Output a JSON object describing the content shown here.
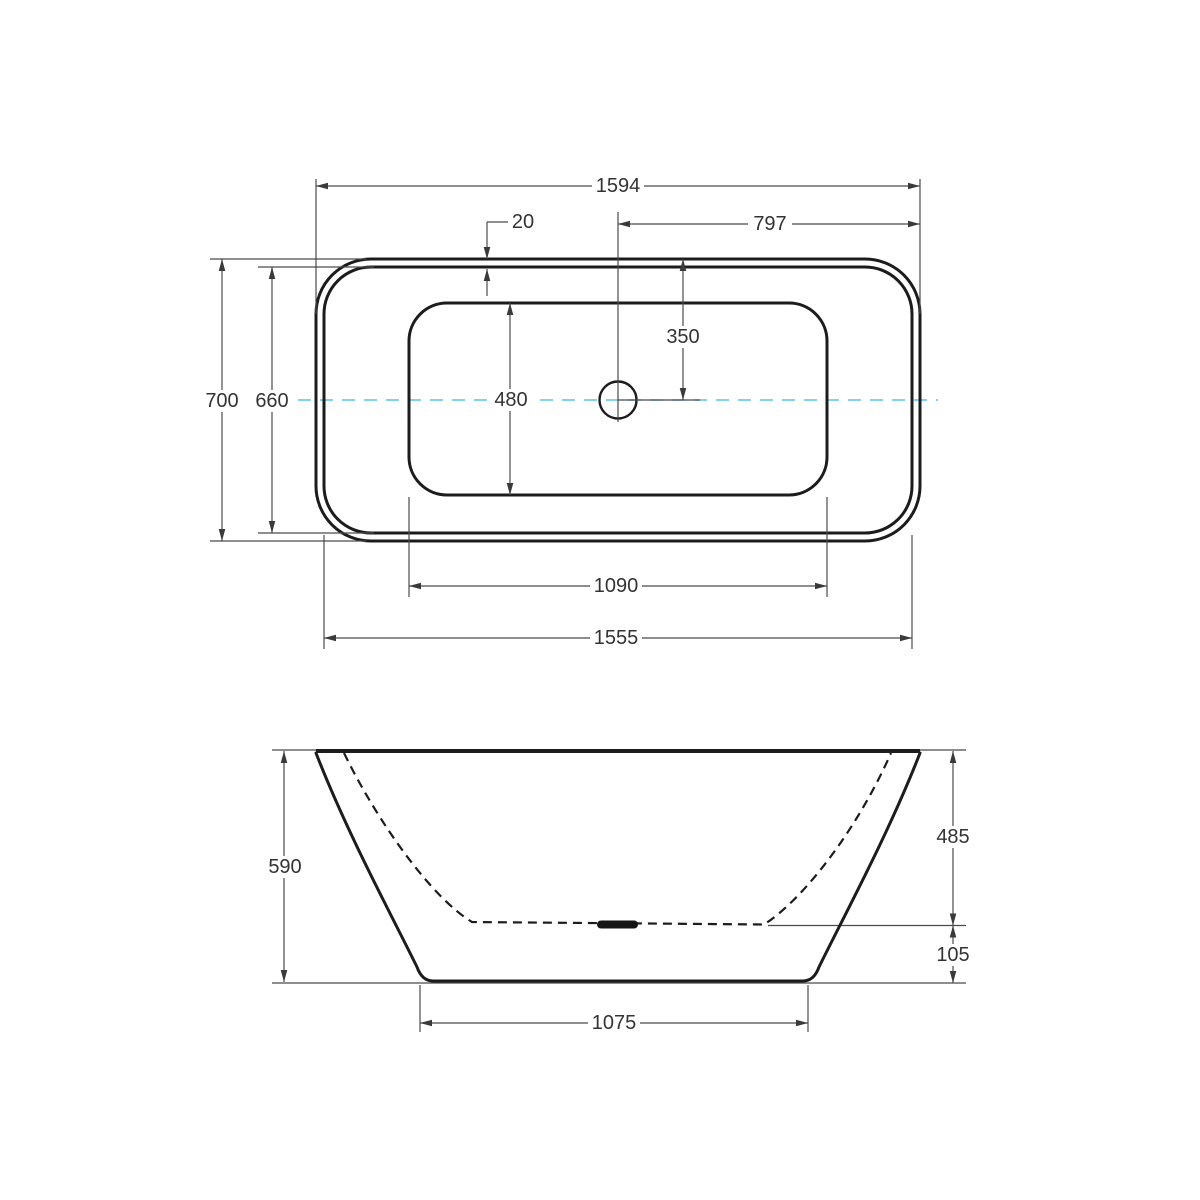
{
  "drawing": {
    "top_view": {
      "dims": {
        "overall_length": "1594",
        "half_length": "797",
        "rim_offset": "20",
        "center_to_edge": "350",
        "overall_width": "700",
        "rim_width": "660",
        "basin_width": "480",
        "basin_length": "1090",
        "rim_length": "1555"
      }
    },
    "side_view": {
      "dims": {
        "overall_height": "590",
        "basin_depth": "485",
        "base_height": "105",
        "base_length": "1075"
      }
    },
    "colors": {
      "centerline": "#58c4e6",
      "outline": "#1c1c1c",
      "dim_line": "#4b4b4b",
      "text": "#333333"
    }
  }
}
